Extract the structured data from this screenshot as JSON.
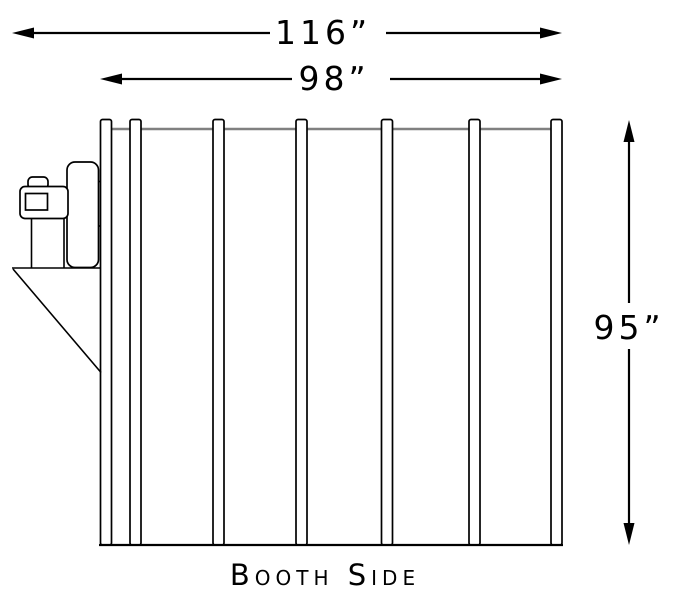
{
  "drawing_title": "Booth Side",
  "caption": "Booth Side",
  "colors": {
    "ink": "#000000",
    "rail_gray": "#808080",
    "background": "#ffffff"
  },
  "dimensions": {
    "overall_width": {
      "label": "116”",
      "value": 116,
      "unit": "in"
    },
    "booth_width": {
      "label": "98”",
      "value": 98,
      "unit": "in"
    },
    "booth_height": {
      "label": "95”",
      "value": 95,
      "unit": "in"
    }
  },
  "structure": {
    "rib_count": 7,
    "panel_count": 6,
    "left_assembly": "fan-and-motor-unit-with-hopper"
  }
}
